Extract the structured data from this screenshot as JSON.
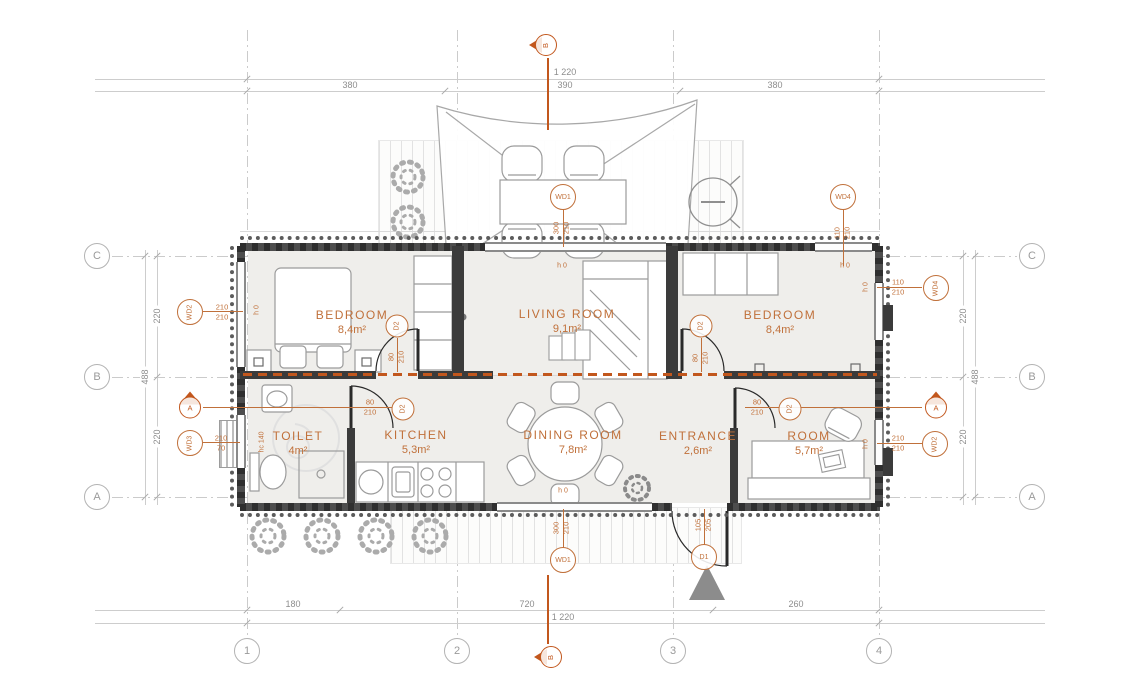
{
  "plan": {
    "type": "container-house-floor-plan"
  },
  "rooms": [
    {
      "name": "BEDROOM",
      "area": "8,4m²"
    },
    {
      "name": "LIVING ROOM",
      "area": "9,1m²"
    },
    {
      "name": "BEDROOM",
      "area": "8,4m²"
    },
    {
      "name": "TOILET",
      "area": "4m²"
    },
    {
      "name": "KITCHEN",
      "area": "5,3m²"
    },
    {
      "name": "DINING ROOM",
      "area": "7,8m²"
    },
    {
      "name": "ENTRANCE",
      "area": "2,6m²"
    },
    {
      "name": "ROOM",
      "area": "5,7m²"
    }
  ],
  "grid": {
    "cols": [
      "1",
      "2",
      "3",
      "4"
    ],
    "rows": [
      "C",
      "B",
      "A"
    ]
  },
  "dims": {
    "top": {
      "total": "1 220",
      "seg1": "380",
      "seg2": "390",
      "seg3": "380"
    },
    "bottom": {
      "seg1": "180",
      "seg2": "720",
      "seg3": "260",
      "total": "1 220"
    },
    "left": {
      "seg1": "220",
      "total": "488",
      "seg2": "220"
    },
    "right": {
      "seg1": "220",
      "total": "488",
      "seg2": "220"
    }
  },
  "markers": {
    "WD1": {
      "label": "WD1",
      "w": "300",
      "h": "210"
    },
    "WD2": {
      "label": "WD2",
      "w": "210",
      "h": "210"
    },
    "WD3": {
      "label": "WD3",
      "w": "210",
      "h": "70"
    },
    "WD4": {
      "label": "WD4",
      "w": "110",
      "h": "210"
    },
    "D1": {
      "label": "D1",
      "w": "105",
      "h": "205"
    },
    "D2": {
      "label": "D2",
      "w": "80",
      "h": "210"
    }
  },
  "sections": {
    "a": "A",
    "b": "B"
  },
  "heights": {
    "h0": "h 0",
    "hc140": "hc 140"
  },
  "colors": {
    "annotation": "#c0703a",
    "section": "#c2571d",
    "wall": "#3b3b3b",
    "grid": "#9a9a9a"
  }
}
